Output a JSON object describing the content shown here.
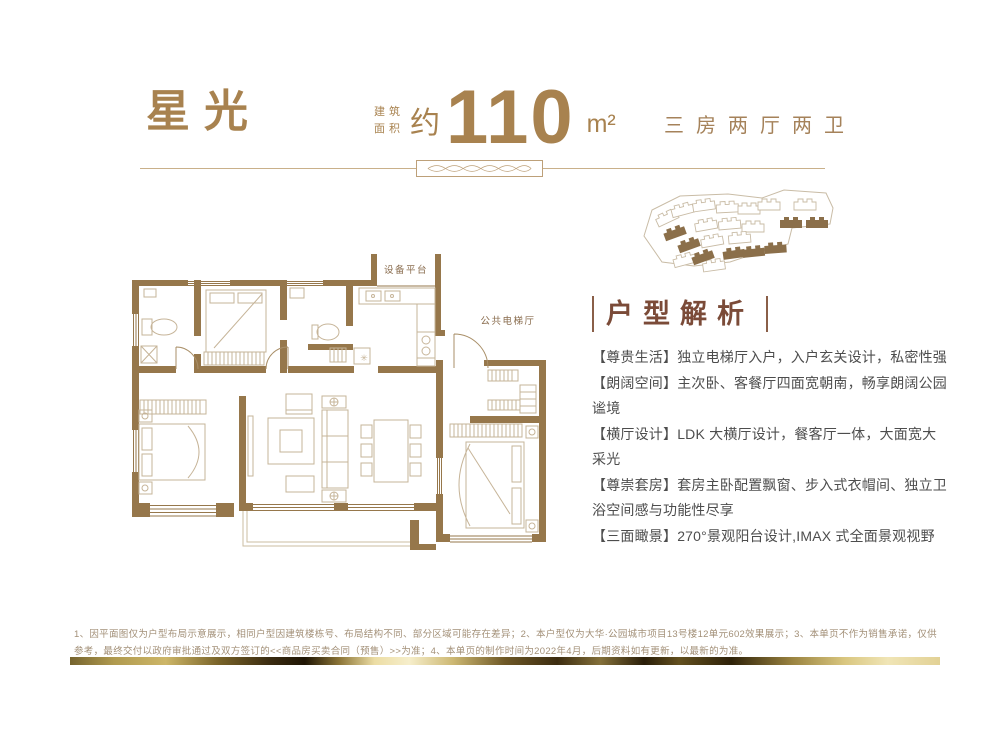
{
  "header": {
    "title": "星光",
    "area": {
      "label_top": "建筑",
      "label_bottom": "面积",
      "approx": "约",
      "value": "110",
      "unit": "m²"
    },
    "layout_spec": "三房两厅两卫"
  },
  "floorplan": {
    "equipment_platform_label": "设备平台",
    "elevator_hall_label": "公共电梯厅",
    "entry_marker": "✳"
  },
  "analysis": {
    "heading": "户型解析",
    "items": [
      "【尊贵生活】独立电梯厅入户，入户玄关设计，私密性强",
      "【朗阔空间】主次卧、客餐厅四面宽朝南，畅享朗阔公园谧境",
      "【横厅设计】LDK 大横厅设计，餐客厅一体，大面宽大采光",
      "【尊崇套房】套房主卧配置飘窗、步入式衣帽间、独立卫浴空间感与功能性尽享",
      "【三面瞰景】270°景观阳台设计,IMAX 式全面景观视野"
    ]
  },
  "footer": {
    "disclaimer": "1、因平面图仅为户型布局示意展示，相同户型因建筑楼栋号、布局结构不同、部分区域可能存在差异；2、本户型仅为大华·公园城市项目13号楼12单元602效果展示；3、本单页不作为销售承诺，仅供参考，最终交付以政府审批通过及双方签订的<<商品房买卖合同（预售）>>为准；4、本单页的制作时间为2022年4月，后期资料如有更新，以最新的为准。"
  },
  "colors": {
    "gold": "#a8824f",
    "wall_brown": "#96774b",
    "furniture_line": "#c6b498",
    "heading_brown": "#7b4b38",
    "body_text": "#4d4d4d",
    "disclaimer_text": "#a39078"
  }
}
